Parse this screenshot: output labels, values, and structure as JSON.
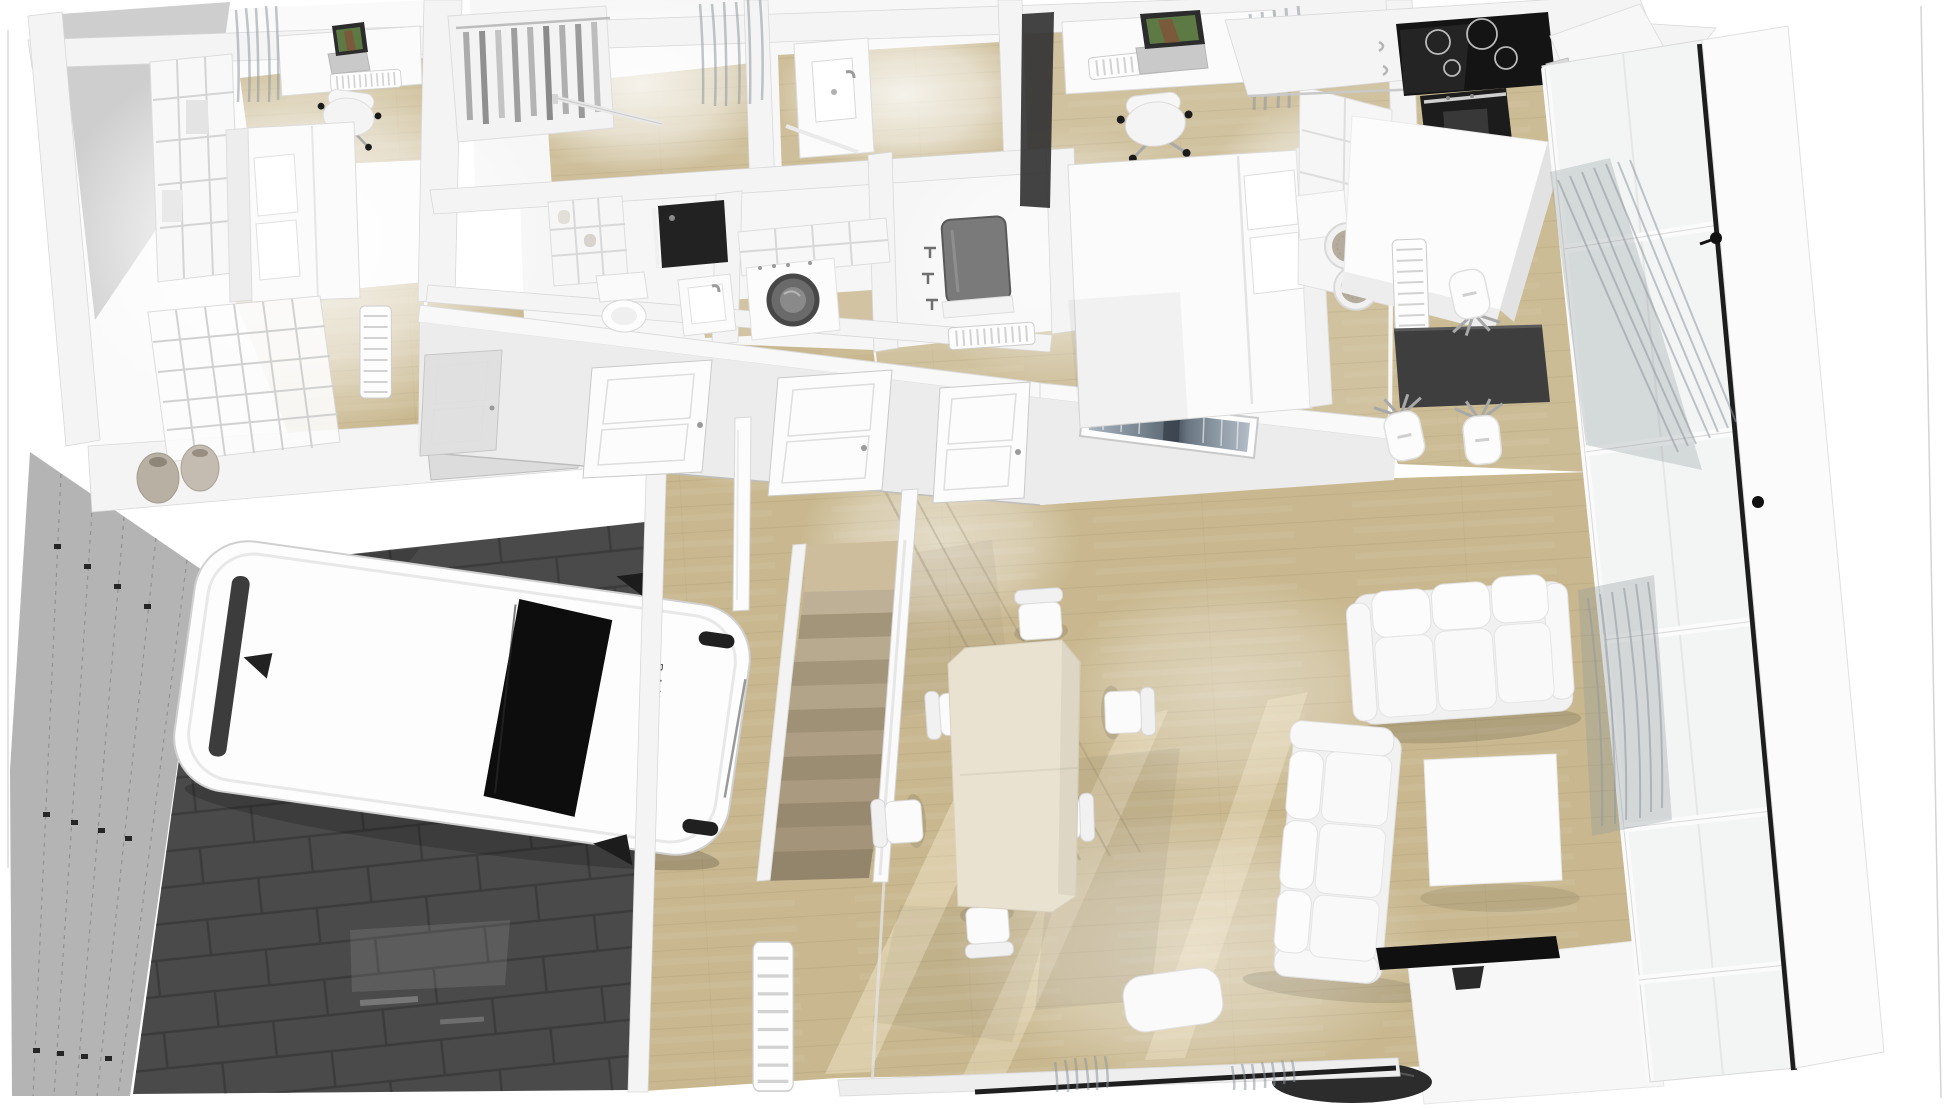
{
  "scene": {
    "type": "3d-floor-plan-render",
    "view": "top-down oblique aerial",
    "floor_label": "ground floor",
    "rooms": [
      {
        "id": "bedroom-1",
        "position": "top-left",
        "furniture": [
          "desk",
          "laptop",
          "office-chair",
          "desk-radiator",
          "bookshelf",
          "bed",
          "pillows",
          "room-divider-screen",
          "decor-vases",
          "wall-radiator",
          "curtains"
        ]
      },
      {
        "id": "dressing-corridor",
        "position": "top-middle-left",
        "furniture": [
          "open-wardrobe-with-hanging-clothes",
          "towel-rail"
        ]
      },
      {
        "id": "bathroom",
        "position": "top-middle",
        "furniture": [
          "vanity-sink",
          "faucet",
          "towel-bar",
          "curtains"
        ]
      },
      {
        "id": "wc",
        "position": "middle",
        "furniture": [
          "cubby-shelf",
          "toilet",
          "dark-shower-panel",
          "washbasin",
          "faucet"
        ]
      },
      {
        "id": "laundry",
        "position": "middle",
        "furniture": [
          "wall-shelves",
          "washing-machine",
          "wall-mirror",
          "wall-taps",
          "radiator"
        ]
      },
      {
        "id": "bedroom-2",
        "position": "top-center-right",
        "furniture": [
          "desk",
          "laptop",
          "office-chair",
          "desk-radiator",
          "double-bed",
          "pillows",
          "headboard",
          "shelving-unit",
          "pouf",
          "pouf",
          "dark-curtain-panel",
          "curtains"
        ]
      },
      {
        "id": "kitchen",
        "position": "top-right",
        "furniture": [
          "induction-cooktop",
          "oven",
          "base-cabinets",
          "tall-cabinet",
          "kitchen-island",
          "vertical-radiator",
          "bar-table",
          "bar-stool",
          "bar-stool",
          "bar-stool"
        ]
      },
      {
        "id": "hallway",
        "position": "center",
        "furniture": [
          "interior-door",
          "interior-door",
          "interior-door",
          "interior-door",
          "framed-picture",
          "staircase",
          "stair-railing",
          "stair-railing",
          "radiator"
        ]
      },
      {
        "id": "dining-area",
        "position": "center",
        "furniture": [
          "dining-table",
          "dining-chair",
          "dining-chair",
          "dining-chair",
          "dining-chair",
          "dining-chair",
          "dining-chair"
        ]
      },
      {
        "id": "living-room",
        "position": "bottom-right",
        "furniture": [
          "sofa-3-seater",
          "sofa-3-seater",
          "coffee-table",
          "tv",
          "tv-cabinet",
          "round-side-table",
          "armchair",
          "curtain-rod",
          "curtains",
          "window-wall"
        ]
      },
      {
        "id": "garage",
        "position": "bottom-left",
        "furniture": [
          "car",
          "sectional-garage-door",
          "dark-tiled-floor",
          "service-door"
        ]
      }
    ],
    "car": {
      "brand_text": "RANGE ROVER",
      "body_color": "white",
      "glass_color": "black"
    },
    "staircase": {
      "steps": 12,
      "material": "light wood"
    },
    "counts": {
      "hallway_doors": 4,
      "dining_chairs": 6,
      "bar_stools": 3,
      "sofas": 2,
      "poufs": 2
    }
  },
  "palette": {
    "bg": "#ffffff",
    "wall": "#f4f4f4",
    "wallEdge": "#d8d8d8",
    "wallFace": "#ececec",
    "wallShade": "#c6c6c6",
    "wood": "#c9b88f",
    "woodDark": "#a8976f",
    "woodLight": "#e6d9b6",
    "garageFloor": "#4a4a4a",
    "garageTile": "#3a3a3a",
    "garageDoor": "#b4b4b4",
    "stairLight": "#bdb096",
    "stairDark": "#a3957a",
    "white": "#fbfbfb",
    "soft": "#f2f2f2",
    "furnEdge": "#dcdcdc",
    "black": "#151515",
    "darkGray": "#3e3e3e",
    "diningTable": "#e9e2d0",
    "curtain": "#8e979c",
    "laptopGreen": "#5d7a44",
    "mirror": "#7a7a7a",
    "pouf": "#b6ac9e"
  }
}
